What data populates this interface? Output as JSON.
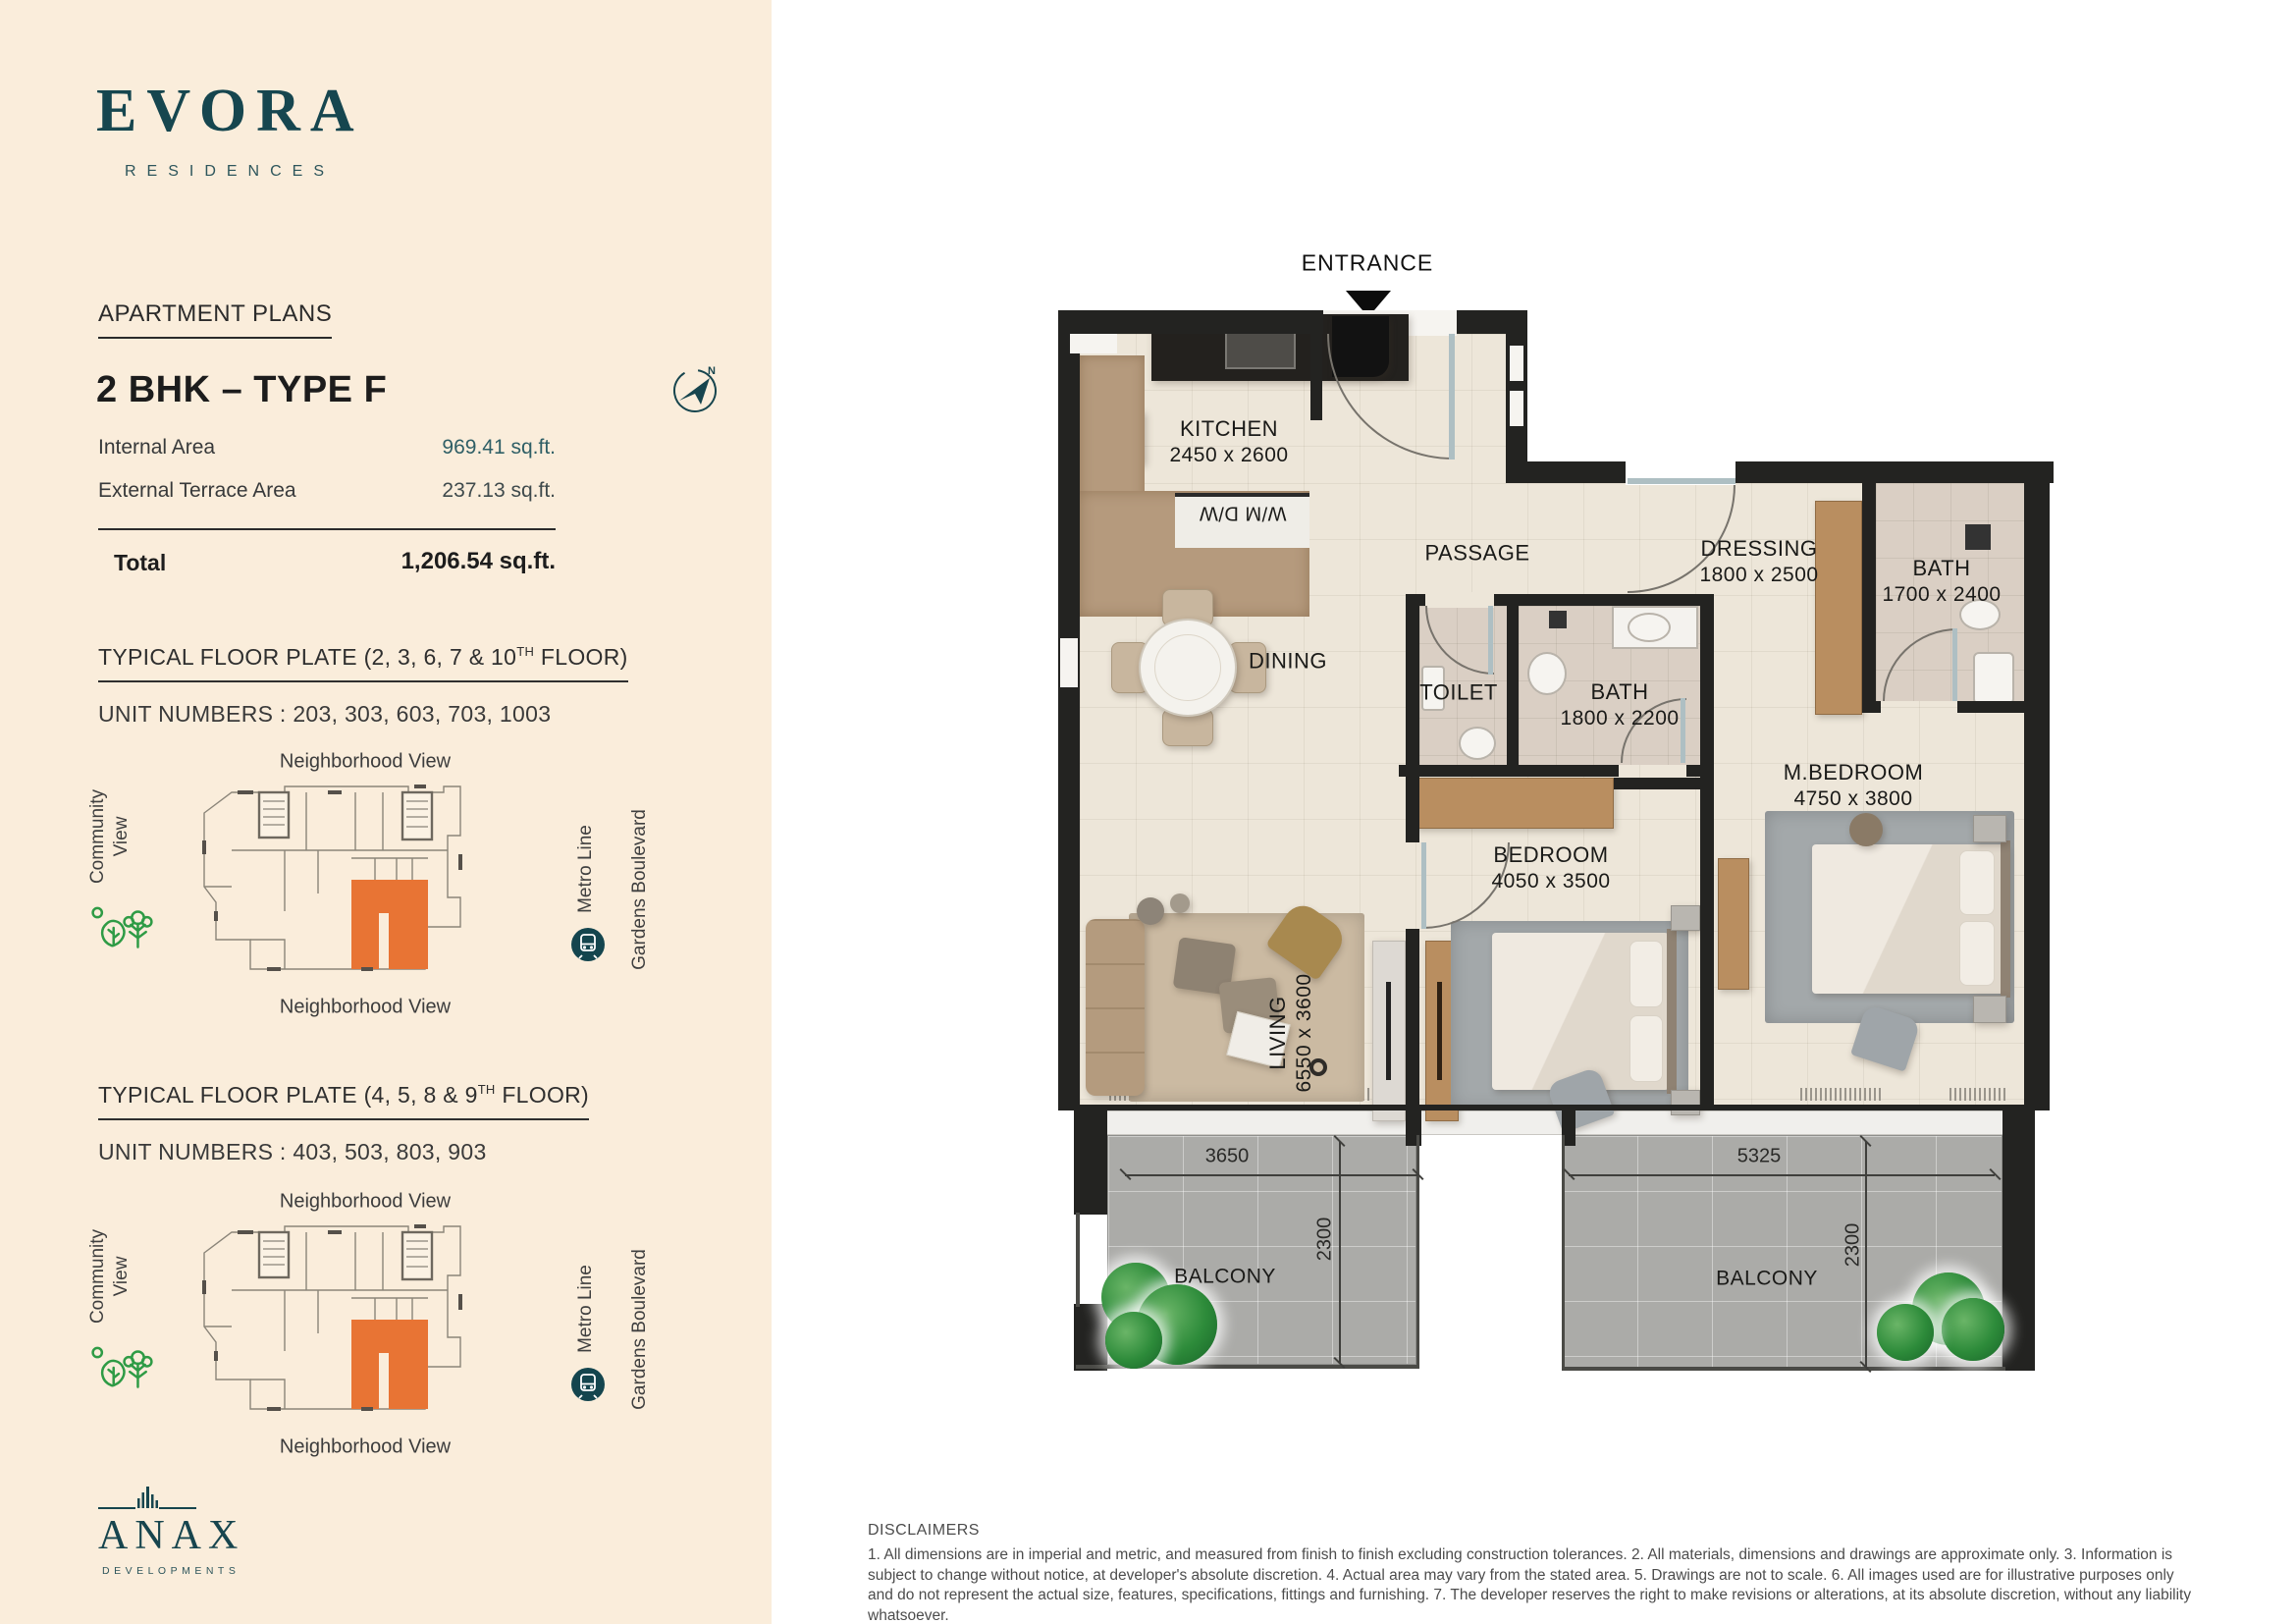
{
  "brand": {
    "name": "EVORA",
    "tagline": "RESIDENCES"
  },
  "sidebar": {
    "section_label": "APARTMENT PLANS",
    "unit_title": "2 BHK – TYPE F",
    "area_rows": [
      {
        "label": "Internal Area",
        "value": "969.41 sq.ft."
      },
      {
        "label": "External Terrace Area",
        "value": "237.13 sq.ft."
      }
    ],
    "total": {
      "label": "Total",
      "value": "1,206.54 sq.ft."
    },
    "plates": [
      {
        "title_pre": "TYPICAL FLOOR PLATE (2, 3, 6, 7 & 10",
        "title_sup": "TH",
        "title_post": " FLOOR)",
        "units": "UNIT NUMBERS : 203, 303, 603, 703, 1003"
      },
      {
        "title_pre": "TYPICAL FLOOR PLATE (4, 5, 8 & 9",
        "title_sup": "TH",
        "title_post": " FLOOR)",
        "units": "UNIT NUMBERS : 403, 503, 803, 903"
      }
    ],
    "mini_plan_labels": {
      "top": "Neighborhood View",
      "bottom": "Neighborhood View",
      "left_line1": "Community",
      "left_line2": "View",
      "metro": "Metro Line",
      "boulevard": "Gardens Boulevard"
    },
    "developer": {
      "name": "ANAX",
      "sub": "DEVELOPMENTS"
    }
  },
  "plan": {
    "entrance": "ENTRANCE",
    "compass_n": "N",
    "appliances": "W/M  D/W",
    "rooms": {
      "kitchen": {
        "name": "KITCHEN",
        "dims": "2450 x 2600"
      },
      "passage": {
        "name": "PASSAGE"
      },
      "dressing": {
        "name": "DRESSING",
        "dims": "1800 x 2500"
      },
      "bath_master": {
        "name": "BATH",
        "dims": "1700 x 2400"
      },
      "toilet": {
        "name": "TOILET"
      },
      "bath": {
        "name": "BATH",
        "dims": "1800 x 2200"
      },
      "dining": {
        "name": "DINING"
      },
      "master_bedroom": {
        "name": "M.BEDROOM",
        "dims": "4750 x 3800"
      },
      "bedroom": {
        "name": "BEDROOM",
        "dims": "4050 x 3500"
      },
      "living": {
        "name": "LIVING",
        "dims": "6550 x 3600"
      },
      "balcony_left": {
        "name": "BALCONY",
        "width": "3650",
        "depth": "2300"
      },
      "balcony_right": {
        "name": "BALCONY",
        "width": "5325",
        "depth": "2300"
      }
    }
  },
  "disclaimers": {
    "title": "DISCLAIMERS",
    "body": "1. All dimensions are in imperial and metric, and measured from finish to finish excluding construction tolerances. 2. All materials, dimensions and drawings are approximate only. 3. Information is subject to change without notice, at developer's absolute discretion. 4. Actual area may vary from the stated area. 5. Drawings are not to scale. 6. All images used are for illustrative purposes only and do not represent the actual size, features, specifications, fittings and furnishing. 7. The developer reserves the right to make revisions or alterations, at its absolute discretion, without any liability whatsoever."
  },
  "colors": {
    "accent_orange": "#E87434",
    "brand_teal": "#16464F",
    "value_teal": "#2F5F66",
    "cream": "#FAEDDB"
  }
}
